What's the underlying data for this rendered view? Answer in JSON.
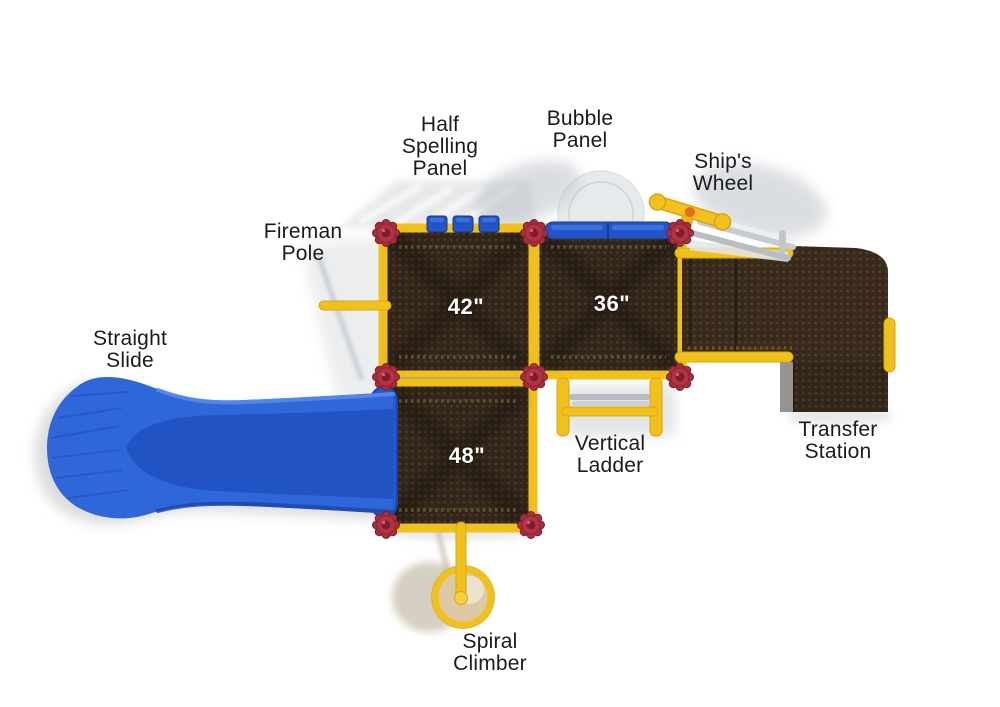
{
  "diagram": {
    "type": "playground-equipment-top-view",
    "callouts": {
      "half_spelling_panel": "Half\nSpelling\nPanel",
      "bubble_panel": "Bubble\nPanel",
      "ships_wheel": "Ship's\nWheel",
      "fireman_pole": "Fireman\nPole",
      "straight_slide": "Straight\nSlide",
      "vertical_ladder": "Vertical\nLadder",
      "transfer_station": "Transfer\nStation",
      "spiral_climber": "Spiral\nClimber"
    },
    "decks": [
      {
        "name": "deck-42",
        "size_label": "42\""
      },
      {
        "name": "deck-36",
        "size_label": "36\""
      },
      {
        "name": "deck-48",
        "size_label": "48\""
      }
    ],
    "colors": {
      "deck_brown": "#32261a",
      "deck_dot": "#56422a",
      "rail_yellow": "#f0c11d",
      "panel_blue": "#2355c8",
      "slide_blue": "#2f67d8",
      "connector_red": "#a82e3d",
      "label_text": "#1b1b1b",
      "deck_label_text": "#ffffff"
    }
  }
}
